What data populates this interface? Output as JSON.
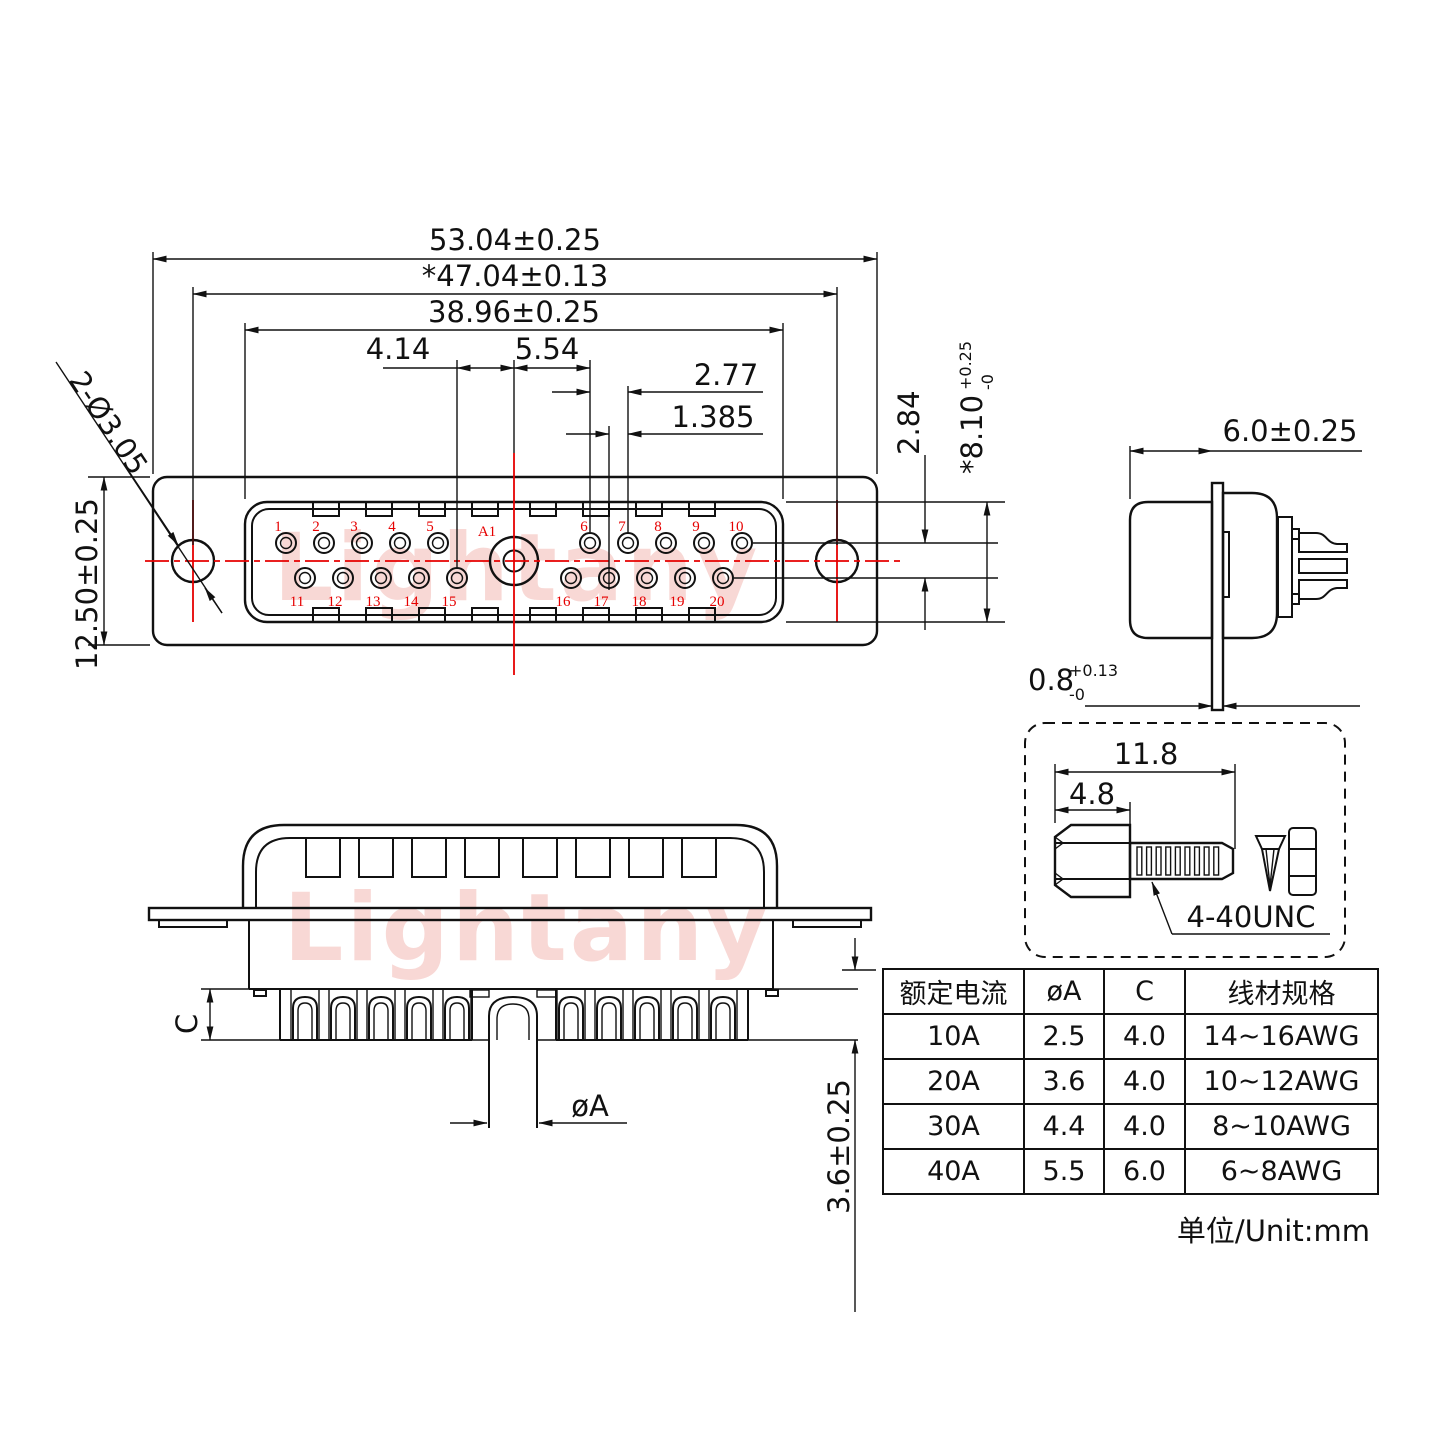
{
  "watermark": {
    "text": "Lightany"
  },
  "front_view": {
    "dim_overall_width": "53.04±0.25",
    "dim_mount_spacing": "*47.04±0.13",
    "dim_shell_width": "38.96±0.25",
    "dim_pin15_to_center": "4.14",
    "dim_center_to_pin6": "5.54",
    "dim_pitch": "2.77",
    "dim_half_pitch": "1.385",
    "dim_row_spacing": "2.84",
    "dim_shell_height": "*8.10",
    "dim_shell_height_tol_plus": "+0.25",
    "dim_shell_height_tol_minus": "-0",
    "dim_body_height": "12.50±0.25",
    "dim_mount_holes": "2-Ø3.05",
    "pin_a1": "A1",
    "pin_numbers": [
      "1",
      "2",
      "3",
      "4",
      "5",
      "6",
      "7",
      "8",
      "9",
      "10",
      "11",
      "12",
      "13",
      "14",
      "15",
      "16",
      "17",
      "18",
      "19",
      "20"
    ]
  },
  "side_view": {
    "dim_depth": "6.0±0.25",
    "dim_flange": "0.8",
    "dim_flange_tol_plus": "+0.13",
    "dim_flange_tol_minus": "-0"
  },
  "bottom_view": {
    "dim_cup_depth": "C",
    "dim_pin_dia": "øA",
    "dim_tail": "3.6±0.25"
  },
  "screw_detail": {
    "dim_total_length": "11.8",
    "dim_head_length": "4.8",
    "thread_spec": "4-40UNC"
  },
  "spec_table": {
    "headers": [
      "额定电流",
      "øA",
      "C",
      "线材规格"
    ],
    "rows": [
      [
        "10A",
        "2.5",
        "4.0",
        "14~16AWG"
      ],
      [
        "20A",
        "3.6",
        "4.0",
        "10~12AWG"
      ],
      [
        "30A",
        "4.4",
        "4.0",
        "8~10AWG"
      ],
      [
        "40A",
        "5.5",
        "6.0",
        "6~8AWG"
      ]
    ]
  },
  "footer": {
    "unit_note": "单位/Unit:mm"
  }
}
